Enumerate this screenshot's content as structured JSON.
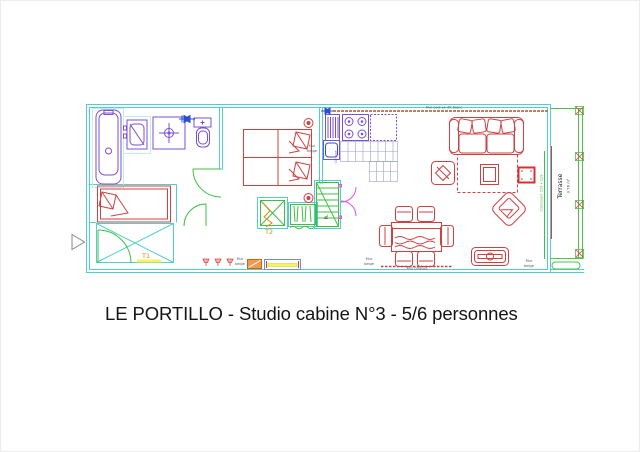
{
  "palette": {
    "wall_cyan": "#4fcfcf",
    "furniture_red": "#cf4040",
    "fixture_violet": "#7a4fd0",
    "door_green": "#3fbf3f",
    "magenta": "#e055e0",
    "orange": "#e8820a",
    "yellow": "#f7f25e",
    "blue": "#2a4fd0",
    "wood_tan": "#b5855f",
    "label_gray": "#555555"
  },
  "title": "LE PORTILLO - Studio cabine N°3 - 5/6 personnes",
  "plan": {
    "labels": {
      "t1": "T1",
      "t2": "T2",
      "closet": "PL",
      "kitchen": "Cuisine",
      "mur": "Mur",
      "beige": "beige",
      "mur_briques": "Mur briques",
      "mur_bois": "Mur bois en dit blanc",
      "terrasse": "Terrasse",
      "terrasse_area": "3.76 m²",
      "coulissant": "Coulissant 229 x 229"
    }
  }
}
